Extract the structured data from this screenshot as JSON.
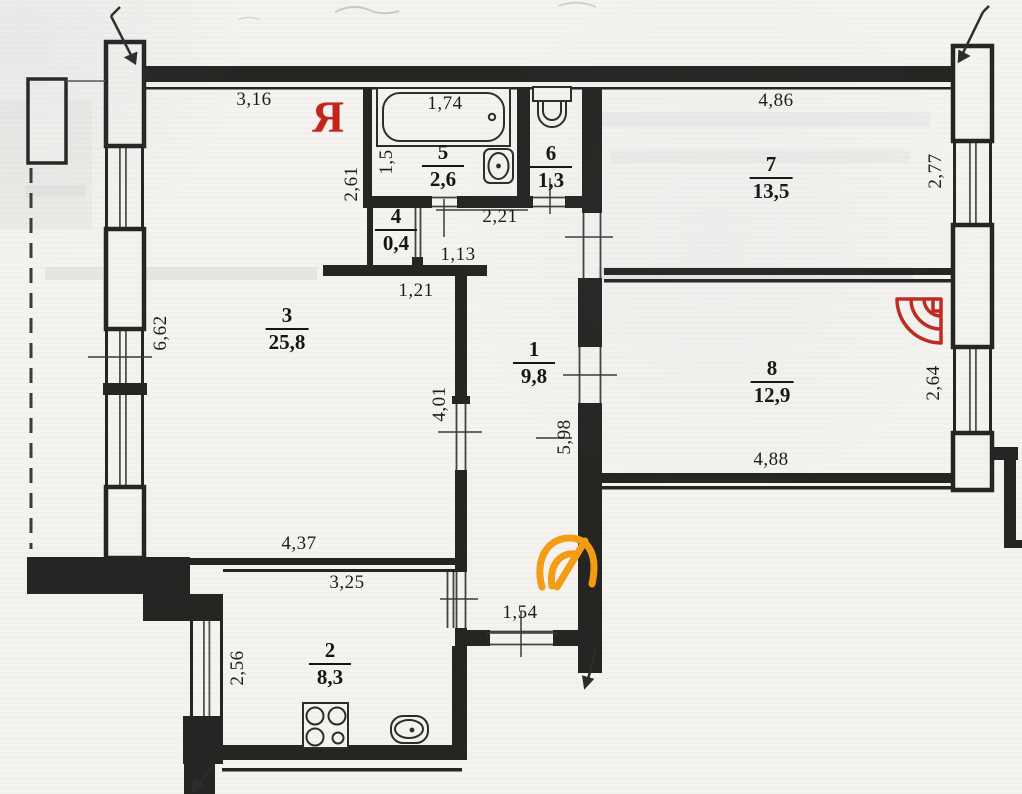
{
  "document": {
    "kind": "apartment-floor-plan-scan",
    "rooms": [
      {
        "number": "1",
        "area": "9,8",
        "x": 534,
        "y": 363
      },
      {
        "number": "2",
        "area": "8,3",
        "x": 330,
        "y": 664
      },
      {
        "number": "3",
        "area": "25,8",
        "x": 287,
        "y": 329
      },
      {
        "number": "4",
        "area": "0,4",
        "x": 396,
        "y": 230
      },
      {
        "number": "5",
        "area": "2,6",
        "x": 443,
        "y": 166
      },
      {
        "number": "6",
        "area": "1,3",
        "x": 551,
        "y": 167
      },
      {
        "number": "7",
        "area": "13,5",
        "x": 771,
        "y": 178
      },
      {
        "number": "8",
        "area": "12,9",
        "x": 772,
        "y": 382
      }
    ],
    "dimensions": [
      {
        "text": "3,16",
        "x": 254,
        "y": 100,
        "rot": false
      },
      {
        "text": "1,74",
        "x": 445,
        "y": 104,
        "rot": false
      },
      {
        "text": "1,5",
        "x": 387,
        "y": 162,
        "rot": true
      },
      {
        "text": "2,61",
        "x": 352,
        "y": 184,
        "rot": true
      },
      {
        "text": "4,86",
        "x": 776,
        "y": 101,
        "rot": false
      },
      {
        "text": "2,77",
        "x": 936,
        "y": 171,
        "rot": true
      },
      {
        "text": "2,21",
        "x": 500,
        "y": 217,
        "rot": false
      },
      {
        "text": "1,13",
        "x": 458,
        "y": 255,
        "rot": false
      },
      {
        "text": "1,21",
        "x": 416,
        "y": 291,
        "rot": false
      },
      {
        "text": "6,62",
        "x": 161,
        "y": 333,
        "rot": true
      },
      {
        "text": "4,01",
        "x": 440,
        "y": 404,
        "rot": true
      },
      {
        "text": "5,98",
        "x": 565,
        "y": 437,
        "rot": true
      },
      {
        "text": "2,64",
        "x": 934,
        "y": 383,
        "rot": true
      },
      {
        "text": "4,88",
        "x": 771,
        "y": 460,
        "rot": false
      },
      {
        "text": "4,37",
        "x": 299,
        "y": 544,
        "rot": false
      },
      {
        "text": "3,25",
        "x": 347,
        "y": 583,
        "rot": false
      },
      {
        "text": "2,56",
        "x": 238,
        "y": 668,
        "rot": true
      },
      {
        "text": "1,54",
        "x": 520,
        "y": 613,
        "rot": false
      }
    ],
    "icons": {
      "ya_letter": "Я",
      "ya_color": "#c4241b",
      "red_fan_logo": "red-quarter-fan-watermark",
      "red_logo_color": "#bf2b20",
      "orange_logo": "orange-shell-swirl-watermark",
      "orange_logo_color": "#f49d15"
    },
    "fixtures": [
      "bathtub",
      "bathroom-sink",
      "toilet",
      "kitchen-stove",
      "kitchen-sink"
    ],
    "colors": {
      "paper": "#f4f3f0",
      "ink": "#262524",
      "thin_line": "#3c3b3a"
    }
  }
}
